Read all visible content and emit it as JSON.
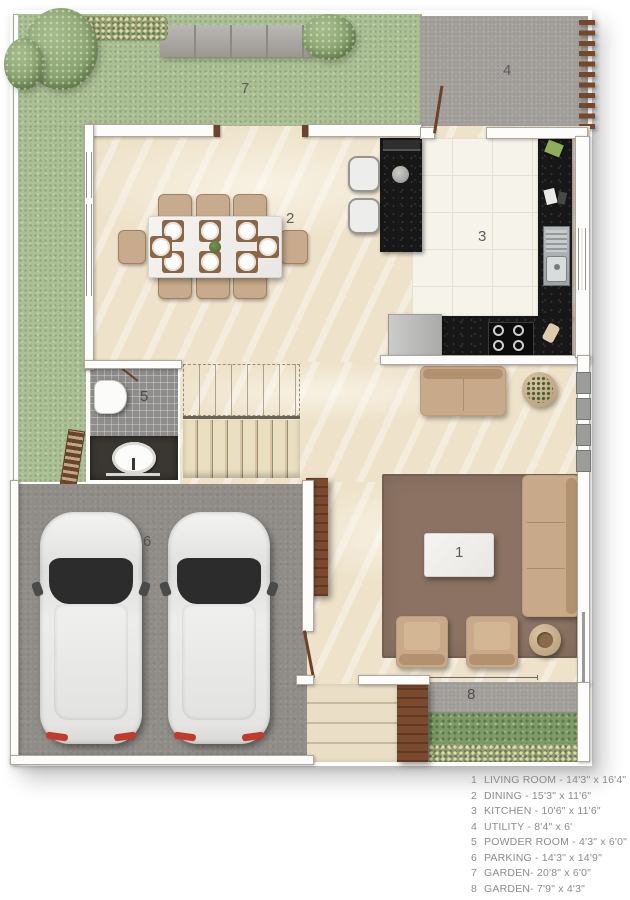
{
  "plan": {
    "labels": {
      "living": "1",
      "dining": "2",
      "kitchen": "3",
      "utility": "4",
      "powder": "5",
      "parking": "6",
      "garden_top": "7",
      "garden_bottom": "8"
    }
  },
  "legend": {
    "items": [
      {
        "num": "1",
        "text": "LIVING ROOM - 14'3\" x 16'4\""
      },
      {
        "num": "2",
        "text": "DINING - 15'3\" x 11'6\""
      },
      {
        "num": "3",
        "text": "KITCHEN - 10'6\" x 11'6\""
      },
      {
        "num": "4",
        "text": "UTILITY - 8'4\" x 6'"
      },
      {
        "num": "5",
        "text": "POWDER ROOM - 4'3\" x 6'0\""
      },
      {
        "num": "6",
        "text": "PARKING - 14'3\" x 14'9\""
      },
      {
        "num": "7",
        "text": "GARDEN- 20'8\" x 6'0\""
      },
      {
        "num": "8",
        "text": "GARDEN- 7'9\" x 4'3\""
      }
    ]
  },
  "colors": {
    "grass": "#acc096",
    "floor_marble": "#eee2ca",
    "kitchen_tile": "#f6f3eb",
    "counter_black": "#171717",
    "parking_gray": "#908d89",
    "utility_gray": "#a5a29e",
    "rug_brown": "#8b7263",
    "sofa_tan": "#c8aa8a",
    "wood_brown": "#7b4a2e",
    "legend_text": "#8b8b8b"
  }
}
